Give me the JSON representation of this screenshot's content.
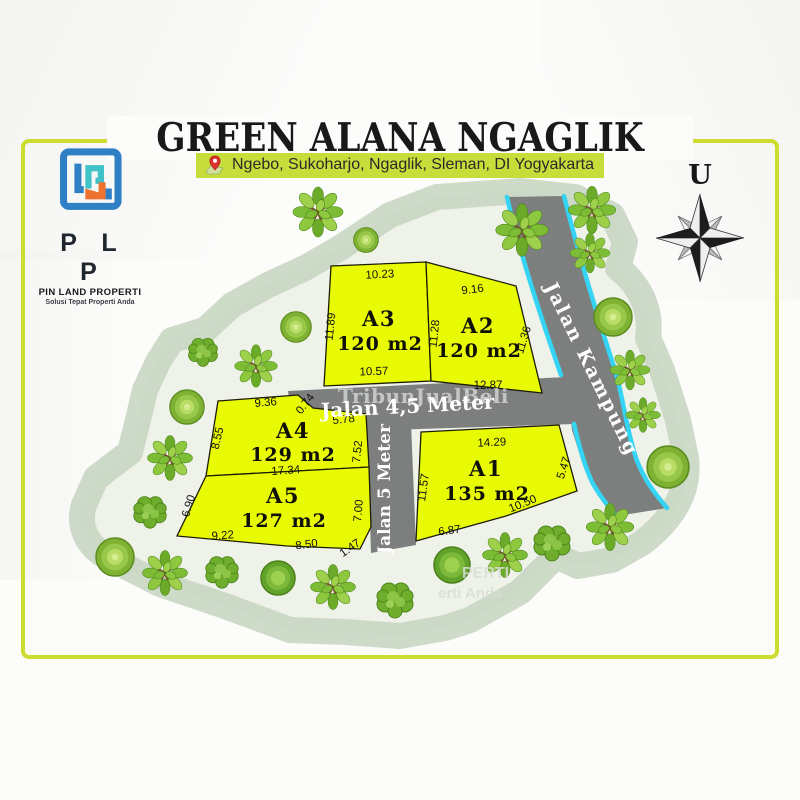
{
  "header": {
    "title": "GREEN ALANA NGAGLIK",
    "location": "Ngebo, Sukoharjo, Ngaglik, Sleman, DI Yogyakarta"
  },
  "logo": {
    "initials": "P L P",
    "company": "PIN LAND PROPERTI",
    "tagline": "Solusi Tepat Properti Anda"
  },
  "compass": {
    "north": "U"
  },
  "site_plan": {
    "roads": [
      {
        "name": "Jalan Kampung"
      },
      {
        "name": "Jalan 4,5 Meter"
      },
      {
        "name": "Jalan 5 Meter"
      }
    ],
    "plots": [
      {
        "id": "A1",
        "area": "135 m2",
        "dims": {
          "top": "14.29",
          "left": "11.57",
          "right": "5.47",
          "bottom_diag": "10.50",
          "bottom": "6.87"
        }
      },
      {
        "id": "A2",
        "area": "120 m2",
        "dims": {
          "top": "9.16",
          "left": "11.28",
          "right": "11.36",
          "bottom": "12.87"
        }
      },
      {
        "id": "A3",
        "area": "120 m2",
        "dims": {
          "top": "10.23",
          "left": "11.89",
          "bottom": "10.57"
        }
      },
      {
        "id": "A4",
        "area": "129 m2",
        "dims": {
          "top": "9.36",
          "top_diag": "0.74",
          "top_right": "5.78",
          "left": "8.55",
          "right": "7.52",
          "bottom": "17.34"
        }
      },
      {
        "id": "A5",
        "area": "127 m2",
        "dims": {
          "left": "6.90",
          "right": "7.00",
          "bottom_left": "9.22",
          "bottom_right": "8.50",
          "bottom_diag": "1.47"
        }
      }
    ]
  },
  "watermark": {
    "brand": "TribunJualBeli",
    "partial_1": "PERTI",
    "partial_2": "erti Anda"
  },
  "colors": {
    "plot_fill": "#e9fa05",
    "road_fill": "#7d7f7e",
    "road_edge": "#35d4f4",
    "land_band": "#c3d2bd",
    "frame": "#ccdd2f",
    "location_bar": "#c7dd3a"
  }
}
